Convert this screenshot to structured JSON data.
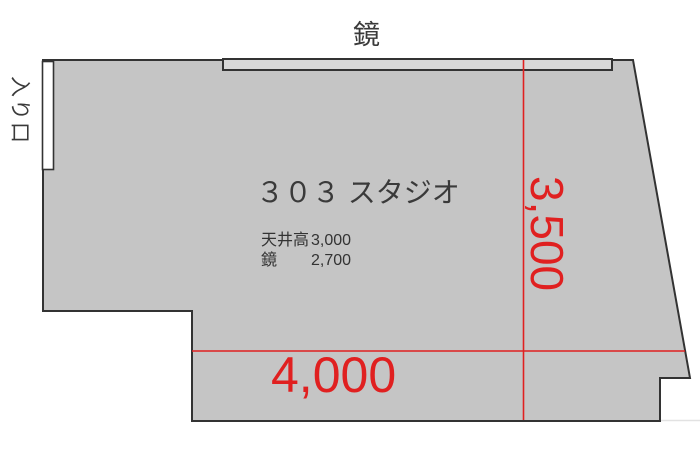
{
  "colors": {
    "floor": "#c5c5c5",
    "mirror_strip": "#d8d8d8",
    "outline": "#333333",
    "dimension_red": "#e02020",
    "text_dark": "#3a3a3a",
    "background": "#ffffff"
  },
  "floorplan": {
    "room_label": "３０３ スタジオ",
    "mirror_label": "鏡",
    "entrance_label": "入り口",
    "specs": [
      {
        "name": "天井高",
        "value": "3,000"
      },
      {
        "name": "鏡",
        "value": "2,700"
      }
    ],
    "dimensions": {
      "horizontal": "4,000",
      "vertical": "3,500"
    }
  }
}
